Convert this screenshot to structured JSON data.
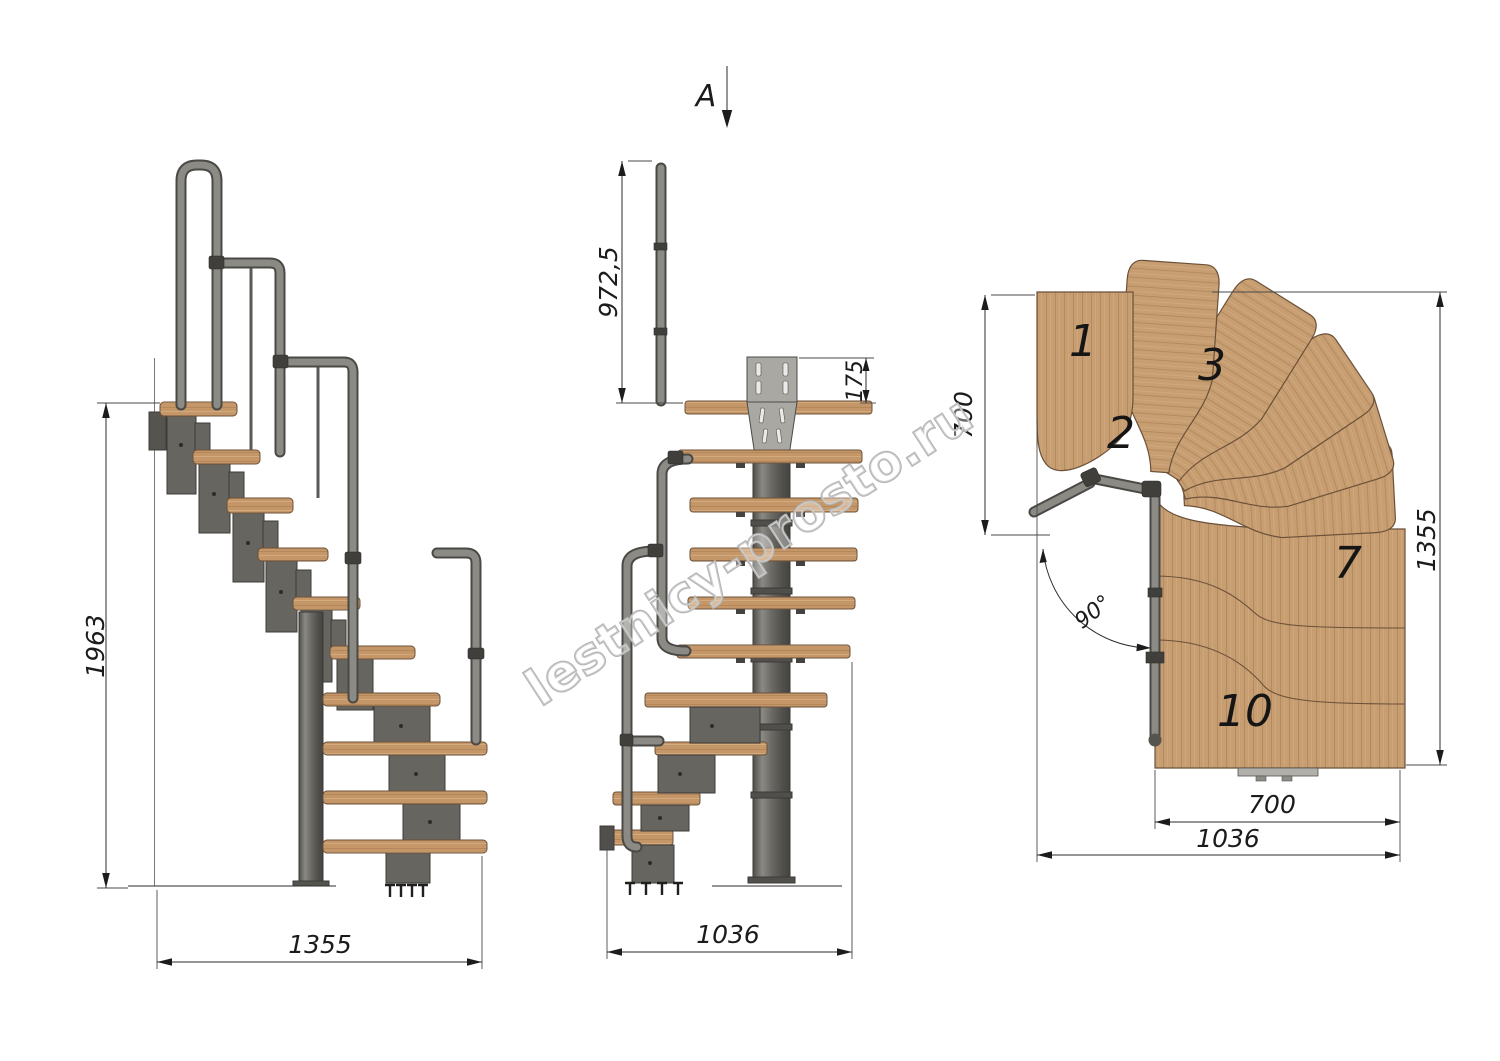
{
  "watermark": "lestnicy-prosto.ru",
  "views": {
    "side": {
      "name": "side-elevation",
      "dims": {
        "height": "1963",
        "length": "1355"
      }
    },
    "front": {
      "name": "front-elevation-view-A",
      "view_label": "A",
      "dims": {
        "handrail_height": "972,5",
        "plate_height": "175",
        "width": "1036"
      }
    },
    "plan": {
      "name": "plan-view",
      "dims": {
        "upper_flight_width": "700",
        "length": "1355",
        "turn_angle": "90°",
        "lower_flight_width": "700",
        "total_width": "1036"
      },
      "tread_labels": [
        "1",
        "2",
        "3",
        "7",
        "10"
      ]
    }
  },
  "colors": {
    "background": "#ffffff",
    "wood": "#c59768",
    "wood_plan": "#c79d72",
    "wood_grain_dark": "#b08457",
    "wood_grain_light": "#d8b289",
    "wood_outline": "#6b5138",
    "metal": "#66655f",
    "metal_dark": "#3c3b38",
    "metal_light": "#8b8a84",
    "plate": "#a9a8a3",
    "dim_line": "#2b2b2b",
    "watermark": "#b4b4b4"
  }
}
